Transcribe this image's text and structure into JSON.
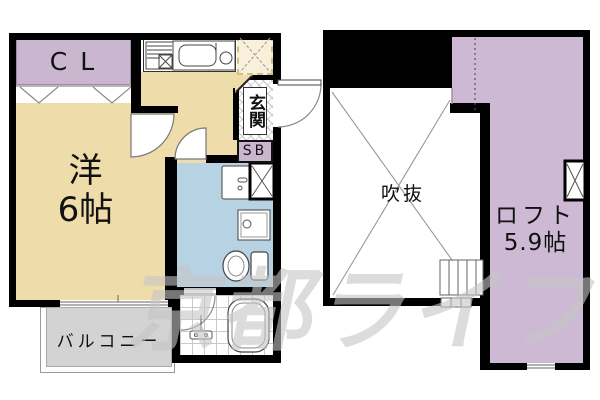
{
  "floor1": {
    "closet": "CL",
    "room_name": "洋",
    "room_size": "6帖",
    "entrance": "玄関",
    "shoe_box": "SB",
    "balcony": "バルコニー"
  },
  "floor2": {
    "void": "吹抜",
    "loft_name": "ロフト",
    "loft_size": "5.9帖"
  },
  "watermark": "京都ライフ",
  "colors": {
    "room_fill": "#eedcab",
    "closet_fill": "#cbb6d0",
    "loft_fill": "#cdb9d3",
    "sanitary_fill": "#b7d2e3",
    "balcony_fill": "#d3d3d3",
    "bath_fill": "#ffffff",
    "wall": "#000000",
    "watermark_gray": "#c4c4c4"
  },
  "icons": {
    "kitchen_stove": "hatched-grill-box",
    "kitchen_sink": "rounded-basin-with-faucet",
    "refrigerator_space": "dashed-box-x",
    "entrance_door": "quarter-arc",
    "room_door": "quarter-pie",
    "sanitary_door": "quarter-pie",
    "bath_door": "quarter-arc",
    "washbasin": "rect-with-faucet",
    "washing_machine_space": "black-frame-x-box",
    "washer_pan": "double-rect-circle",
    "toilet": "oval-bowl-with-tank",
    "bathtub": "double-rounded-rect",
    "shower": "mixer-glyph",
    "loft_ladder": "rung-box",
    "void_cross": "diagonal-x",
    "closet_doors": "double-v",
    "window": "double-line-gap",
    "loft_window_box": "black-frame-x-box"
  }
}
